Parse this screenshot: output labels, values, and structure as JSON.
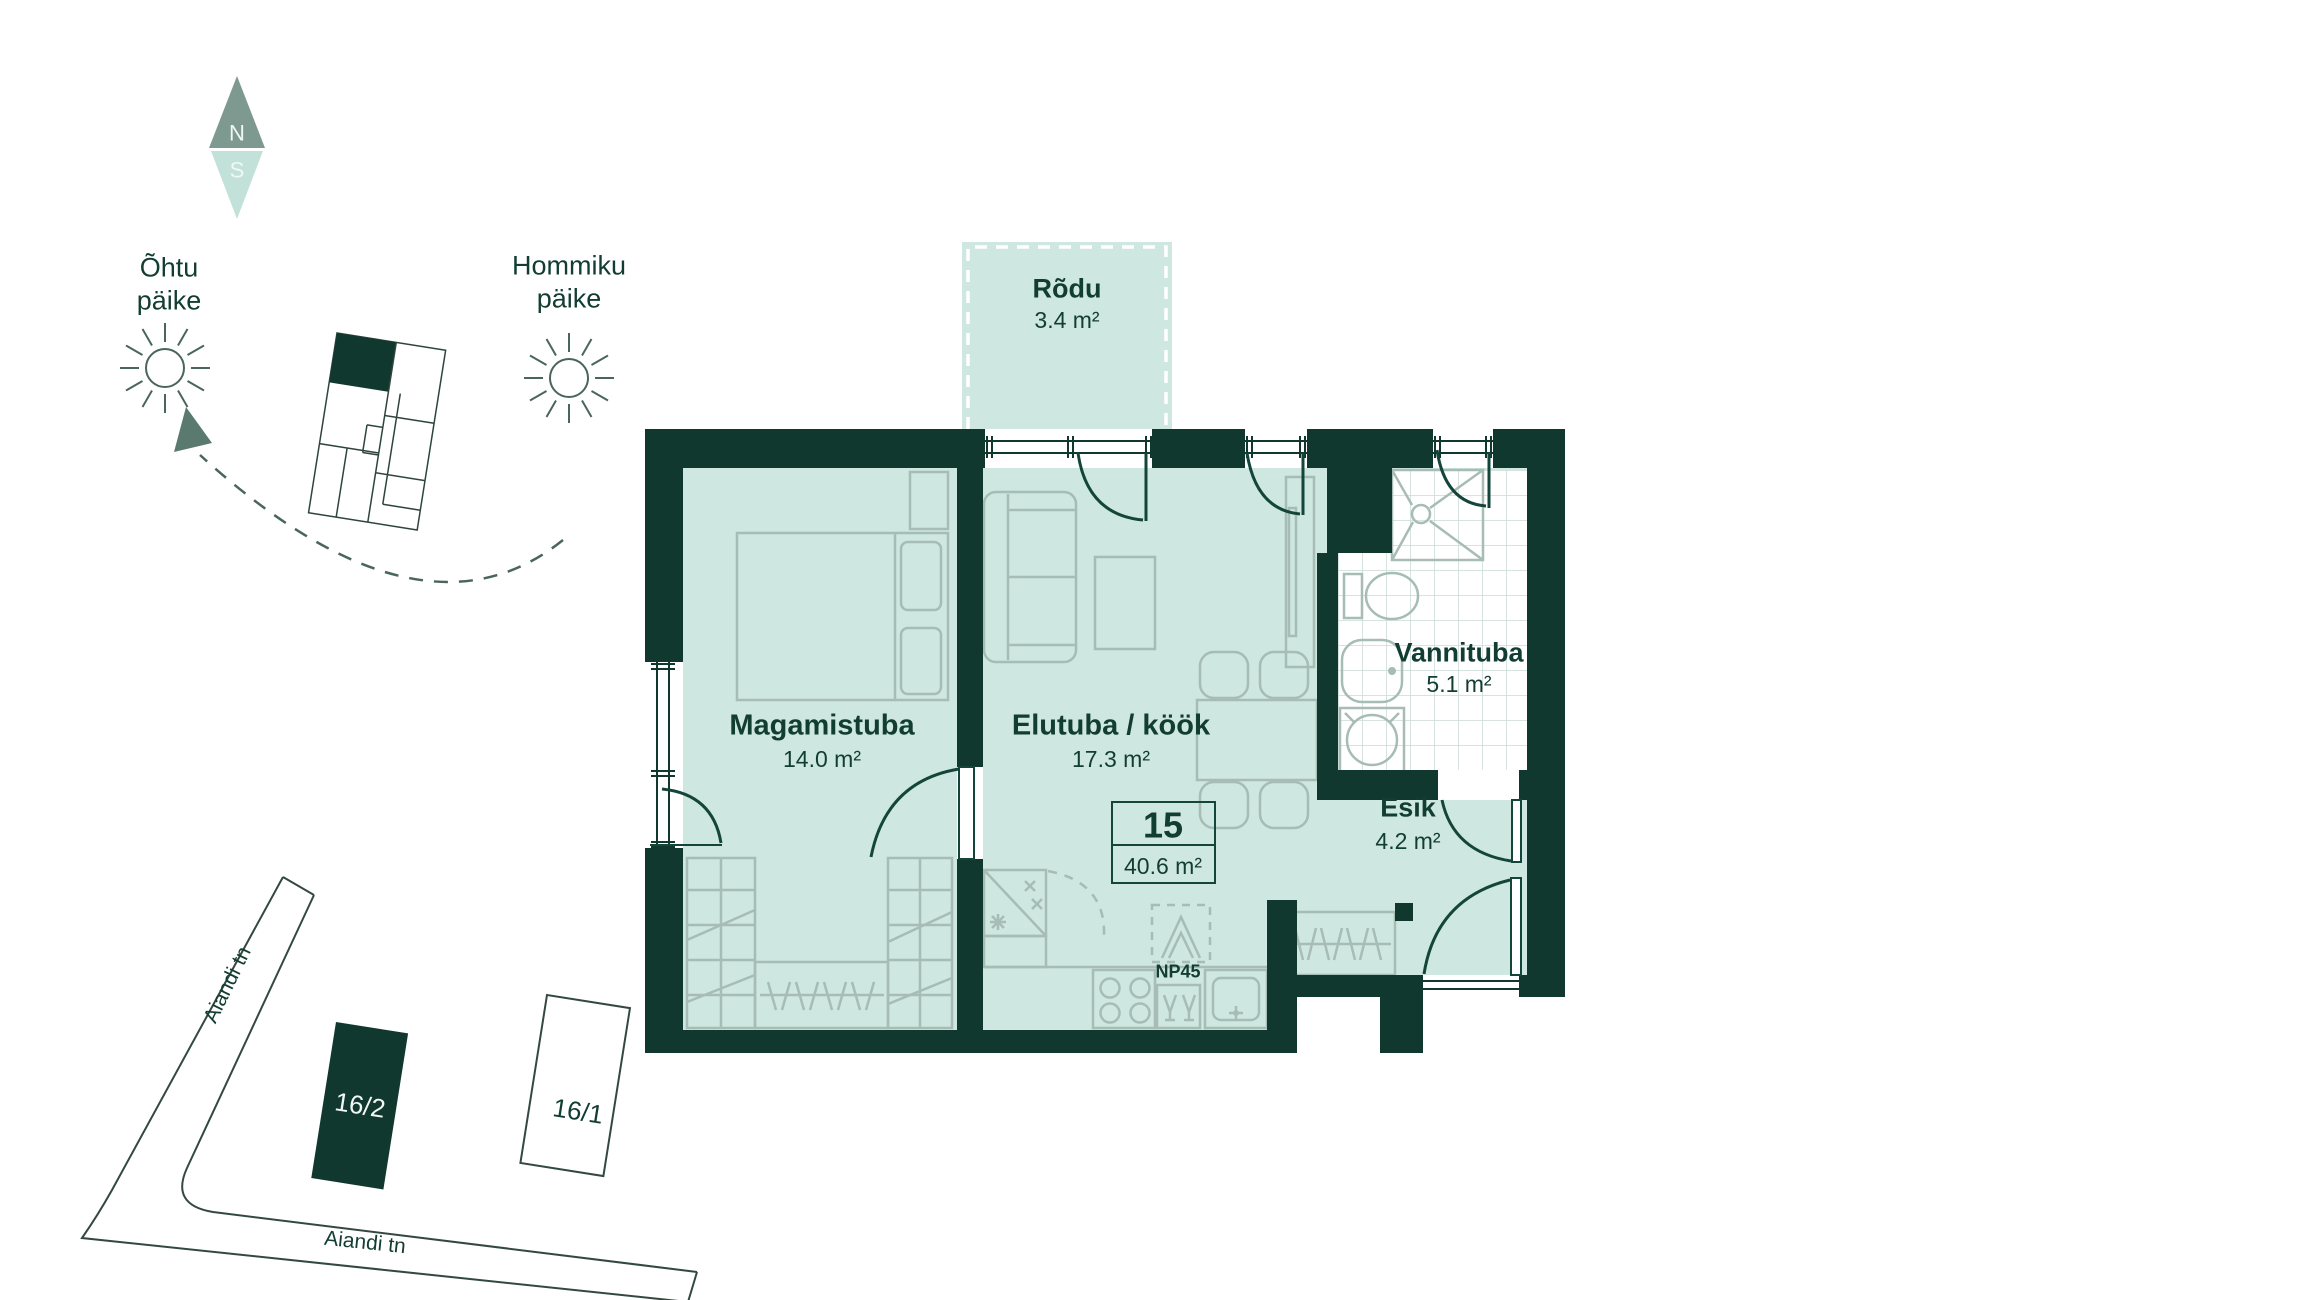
{
  "title": "Apartment 15 floor plan",
  "compass": {
    "north": "N",
    "south": "S"
  },
  "suns": {
    "evening_line1": "Õhtu",
    "evening_line2": "päike",
    "morning_line1": "Hommiku",
    "morning_line2": "päike"
  },
  "apartment": {
    "number": "15",
    "total_area": "40.6 m²",
    "appliance_label": "NP45"
  },
  "rooms": {
    "balcony": {
      "name": "Rõdu",
      "area": "3.4 m²"
    },
    "bedroom": {
      "name": "Magamistuba",
      "area": "14.0 m²"
    },
    "living": {
      "name": "Elutuba / köök",
      "area": "17.3 m²"
    },
    "bathroom": {
      "name": "Vannituba",
      "area": "5.1 m²"
    },
    "hallway": {
      "name": "Esik",
      "area": "4.2 m²"
    }
  },
  "site": {
    "street_upper": "Aiandi tn",
    "street_lower": "Aiandi tn",
    "building_current": "16/2",
    "building_adjacent": "16/1"
  },
  "colors": {
    "wall": "#11382E",
    "floor": "#CEE7E0",
    "text_green": "#123D32",
    "furniture": "#A6BCB5",
    "compass_north": "#7E998F",
    "compass_south": "#C2E2D9"
  }
}
